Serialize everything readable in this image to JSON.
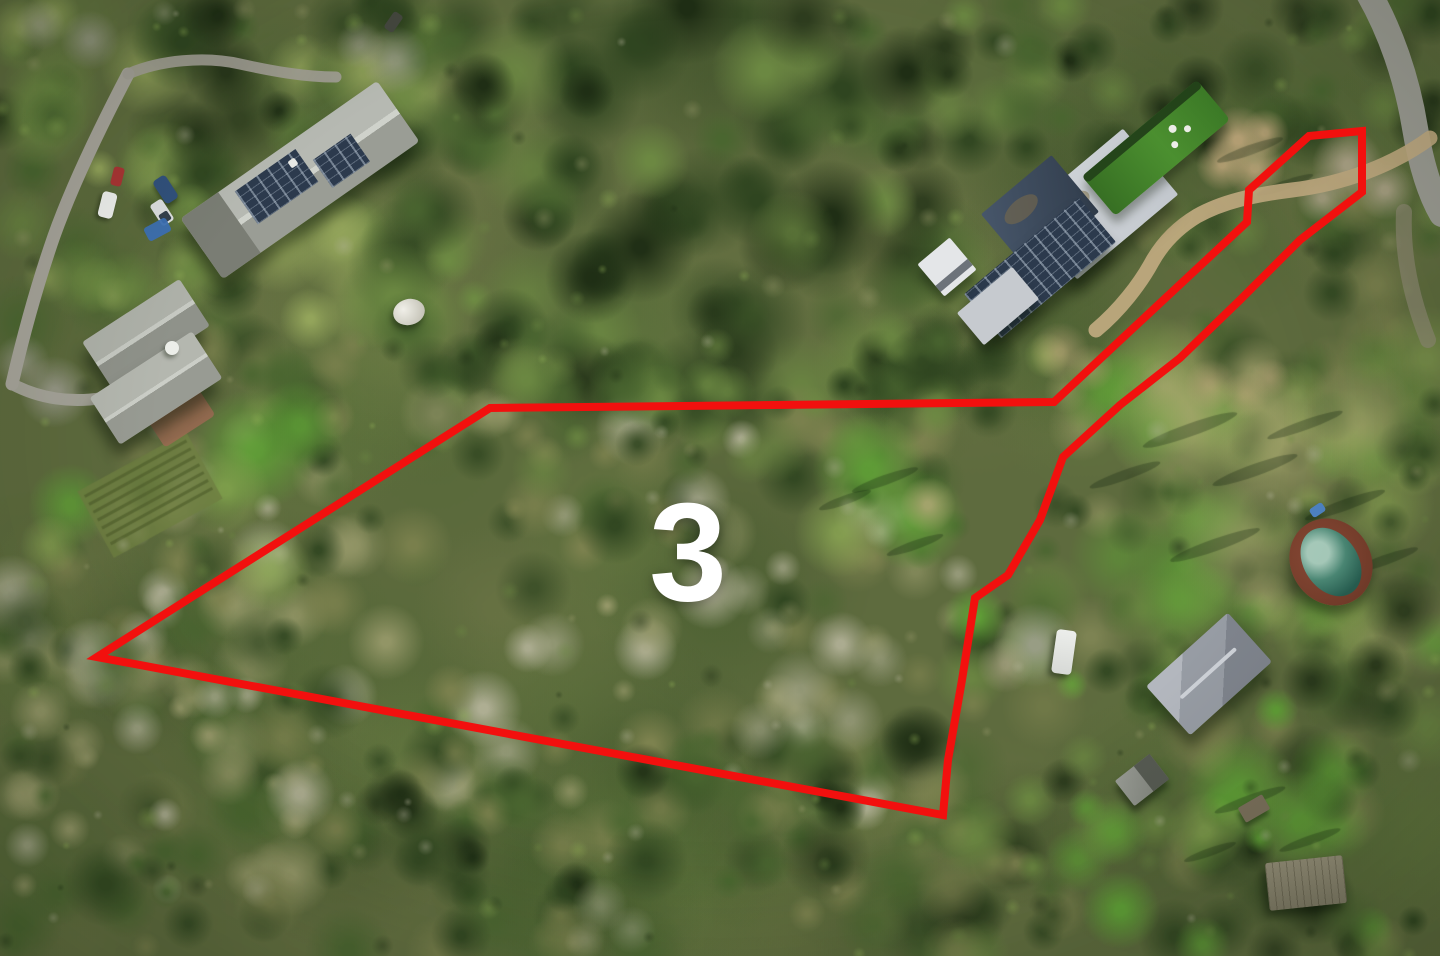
{
  "scene": {
    "description": "Aerial drone photograph of a wooded hillside neighborhood; a parcel of oak woodland and meadow is outlined in red and labeled 3",
    "terrain": "oak woodland, dry scrub, bright grass meadows, dirt drives and paved roads"
  },
  "parcel_label": {
    "text": "3",
    "color": "#ffffff",
    "font_size_px": 140,
    "center": {
      "x": 688,
      "y": 558
    }
  },
  "boundary": {
    "color": "#f2100e",
    "stroke_width": 8,
    "points": [
      [
        97,
        657
      ],
      [
        490,
        408
      ],
      [
        1054,
        402
      ],
      [
        1247,
        222
      ],
      [
        1249,
        190
      ],
      [
        1309,
        136
      ],
      [
        1362,
        131
      ],
      [
        1362,
        192
      ],
      [
        1300,
        240
      ],
      [
        1240,
        300
      ],
      [
        1180,
        358
      ],
      [
        1120,
        405
      ],
      [
        1063,
        457
      ],
      [
        1040,
        520
      ],
      [
        1008,
        575
      ],
      [
        975,
        598
      ],
      [
        962,
        680
      ],
      [
        948,
        760
      ],
      [
        943,
        815
      ]
    ]
  },
  "palette": {
    "base": "#5e6b3e",
    "tree_darkest": "#1f2e15",
    "tree_dark": "#2f4520",
    "tree_mid": "#4a6630",
    "tree_light": "#6d8a43",
    "tree_yellow": "#93a45b",
    "scrub_olive": "#7d824f",
    "scrub_sage": "#97996a",
    "dead_pale": "#b3b298",
    "meadow_bright": "#61a437",
    "meadow_light": "#8fae55",
    "grass_tan": "#aaa671",
    "dirt_tan": "#c0a87c",
    "road_gray": "#a7a49b",
    "gravel_gray": "#b5a98f",
    "shadow_dark": "#152511",
    "roof_gray": "#9da09b",
    "roof_light": "#c6cad0",
    "pool_teal": "#2f6f60",
    "pool_light": "#a9cdbd",
    "deck_brown": "#7c4030",
    "lawn_green": "#3e7f28"
  },
  "features": [
    {
      "name": "parcel-boundary",
      "description": "red outline around wooded lot"
    },
    {
      "name": "parcel-number-label",
      "description": "large white numeral on lot"
    },
    {
      "name": "house-top-left",
      "description": "long gray shingle roof with rooftop solar panels"
    },
    {
      "name": "house-left-lower",
      "description": "gabled gray roof home below the first house"
    },
    {
      "name": "white-car",
      "description": "white car parked on lane"
    },
    {
      "name": "red-car",
      "description": "red car parked on lane"
    },
    {
      "name": "blue-suv",
      "description": "dark blue vehicle in driveway"
    },
    {
      "name": "white-pickup",
      "description": "white pickup in driveway"
    },
    {
      "name": "blue-tarp",
      "description": "blue tarp near driveway"
    },
    {
      "name": "dome-tent",
      "description": "small white dome structure in garden"
    },
    {
      "name": "modern-house",
      "description": "large flat-roof modern home with solar arrays"
    },
    {
      "name": "guest-building",
      "description": "small white outbuilding beside modern home"
    },
    {
      "name": "lawn-modern-house",
      "description": "manicured green lawn with white patio tables"
    },
    {
      "name": "road-top-left",
      "description": "narrow winding paved lane"
    },
    {
      "name": "road-top-right",
      "description": "paved road at top right corner"
    },
    {
      "name": "driveway-top-right",
      "description": "dirt drive from road into parcels"
    },
    {
      "name": "tilled-garden",
      "description": "row garden plot on left meadow"
    },
    {
      "name": "swimming-pool",
      "description": "oval pool with red-brown deck"
    },
    {
      "name": "house-bottom-right",
      "description": "gray hip-roof house among trees"
    },
    {
      "name": "white-rv",
      "description": "white RV parked in clearing"
    },
    {
      "name": "cabin-bottom-right",
      "description": "small cabin roof"
    },
    {
      "name": "shed-bottom-right",
      "description": "small shed"
    },
    {
      "name": "structure-bottom-right",
      "description": "flat wooden deck structure"
    }
  ]
}
